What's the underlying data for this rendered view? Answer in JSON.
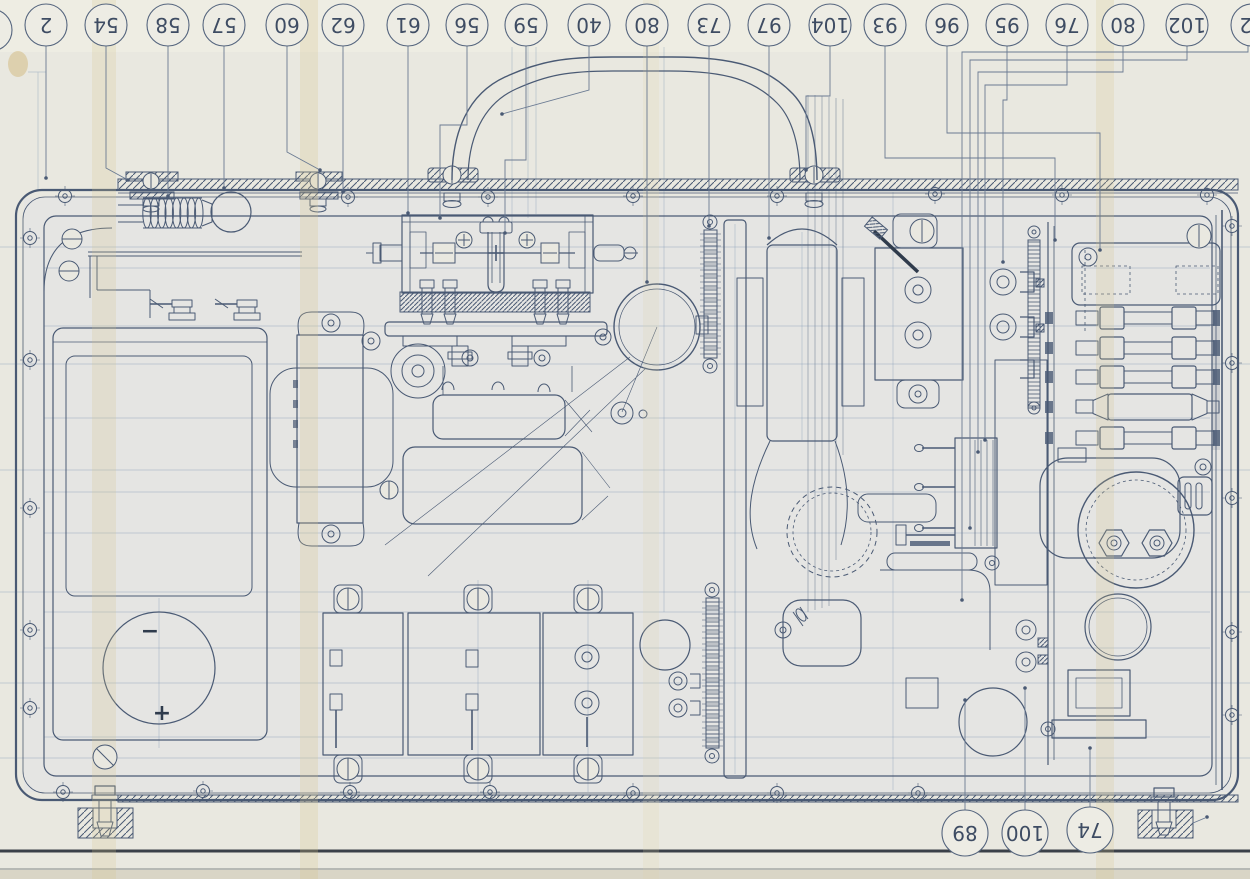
{
  "meta": {
    "colors": {
      "paper": "#e9e8e0",
      "ink": "#4a5a74",
      "ink_dark": "#2f3b4c",
      "shadow_line": "#3a4049",
      "fold_crease": "#d8c489"
    }
  },
  "drawing": {
    "battery_cell": {
      "minus": "−",
      "plus": "+"
    },
    "top_callouts": [
      {
        "label": "",
        "x": -9,
        "y": 30,
        "r": 21,
        "leader": []
      },
      {
        "label": "2",
        "x": 46,
        "y": 25,
        "r": 21,
        "leader": [
          [
            46,
            46
          ],
          [
            46,
            178
          ]
        ]
      },
      {
        "label": "54",
        "x": 106,
        "y": 25,
        "r": 21,
        "leader": [
          [
            106,
            46
          ],
          [
            106,
            168
          ],
          [
            128,
            180
          ]
        ]
      },
      {
        "label": "58",
        "x": 168,
        "y": 25,
        "r": 21,
        "leader": [
          [
            168,
            46
          ],
          [
            168,
            196
          ]
        ]
      },
      {
        "label": "57",
        "x": 224,
        "y": 25,
        "r": 21,
        "leader": [
          [
            224,
            46
          ],
          [
            224,
            188
          ]
        ]
      },
      {
        "label": "60",
        "x": 287,
        "y": 25,
        "r": 21,
        "leader": [
          [
            287,
            46
          ],
          [
            287,
            152
          ],
          [
            320,
            170
          ]
        ]
      },
      {
        "label": "62",
        "x": 343,
        "y": 25,
        "r": 21,
        "leader": [
          [
            343,
            46
          ],
          [
            343,
            192
          ]
        ]
      },
      {
        "label": "61",
        "x": 408,
        "y": 25,
        "r": 21,
        "leader": [
          [
            408,
            46
          ],
          [
            408,
            213
          ]
        ]
      },
      {
        "label": "56",
        "x": 467,
        "y": 25,
        "r": 21,
        "leader": [
          [
            467,
            46
          ],
          [
            467,
            125
          ],
          [
            440,
            125
          ],
          [
            440,
            218
          ]
        ]
      },
      {
        "label": "59",
        "x": 526,
        "y": 25,
        "r": 21,
        "leader": [
          [
            526,
            46
          ],
          [
            526,
            160
          ],
          [
            505,
            160
          ],
          [
            505,
            233
          ]
        ]
      },
      {
        "label": "40",
        "x": 589,
        "y": 25,
        "r": 21,
        "leader": [
          [
            589,
            46
          ],
          [
            589,
            90
          ],
          [
            502,
            114
          ]
        ]
      },
      {
        "label": "80",
        "x": 647,
        "y": 25,
        "r": 21,
        "leader": [
          [
            647,
            46
          ],
          [
            647,
            282
          ]
        ]
      },
      {
        "label": "73",
        "x": 709,
        "y": 25,
        "r": 21,
        "leader": [
          [
            709,
            46
          ],
          [
            709,
            226
          ]
        ]
      },
      {
        "label": "97",
        "x": 769,
        "y": 25,
        "r": 21,
        "leader": [
          [
            769,
            46
          ],
          [
            769,
            238
          ]
        ]
      },
      {
        "label": "104",
        "x": 830,
        "y": 25,
        "r": 21,
        "leader": [
          [
            830,
            46
          ],
          [
            830,
            96
          ],
          [
            806,
            96
          ],
          [
            806,
            170
          ]
        ]
      },
      {
        "label": "93",
        "x": 885,
        "y": 25,
        "r": 21,
        "leader": [
          [
            885,
            46
          ],
          [
            885,
            158
          ],
          [
            1055,
            158
          ],
          [
            1055,
            240
          ]
        ]
      },
      {
        "label": "96",
        "x": 947,
        "y": 25,
        "r": 21,
        "leader": [
          [
            947,
            46
          ],
          [
            947,
            133
          ],
          [
            1100,
            133
          ],
          [
            1100,
            250
          ]
        ]
      },
      {
        "label": "95",
        "x": 1007,
        "y": 25,
        "r": 21,
        "leader": [
          [
            1007,
            46
          ],
          [
            1007,
            100
          ],
          [
            1003,
            100
          ],
          [
            1003,
            262
          ]
        ]
      },
      {
        "label": "76",
        "x": 1067,
        "y": 25,
        "r": 21,
        "leader": [
          [
            1067,
            46
          ],
          [
            1067,
            85
          ],
          [
            985,
            85
          ],
          [
            985,
            440
          ]
        ]
      },
      {
        "label": "80",
        "x": 1123,
        "y": 25,
        "r": 21,
        "leader": [
          [
            1123,
            46
          ],
          [
            1123,
            72
          ],
          [
            978,
            72
          ],
          [
            978,
            452
          ]
        ]
      },
      {
        "label": "102",
        "x": 1187,
        "y": 25,
        "r": 21,
        "leader": [
          [
            1187,
            46
          ],
          [
            1187,
            60
          ],
          [
            970,
            60
          ],
          [
            970,
            528
          ]
        ]
      },
      {
        "label": "82",
        "x": 1252,
        "y": 25,
        "r": 21,
        "leader": [
          [
            1248,
            46
          ],
          [
            1248,
            52
          ],
          [
            962,
            52
          ],
          [
            962,
            600
          ]
        ]
      }
    ],
    "bottom_callouts": [
      {
        "label": "89",
        "x": 965,
        "y": 833,
        "r": 23,
        "leader": [
          [
            965,
            810
          ],
          [
            965,
            700
          ]
        ]
      },
      {
        "label": "100",
        "x": 1025,
        "y": 833,
        "r": 23,
        "leader": [
          [
            1025,
            810
          ],
          [
            1025,
            688
          ]
        ]
      },
      {
        "label": "74",
        "x": 1090,
        "y": 830,
        "r": 23,
        "leader": [
          [
            1090,
            807
          ],
          [
            1090,
            748
          ]
        ]
      }
    ]
  }
}
